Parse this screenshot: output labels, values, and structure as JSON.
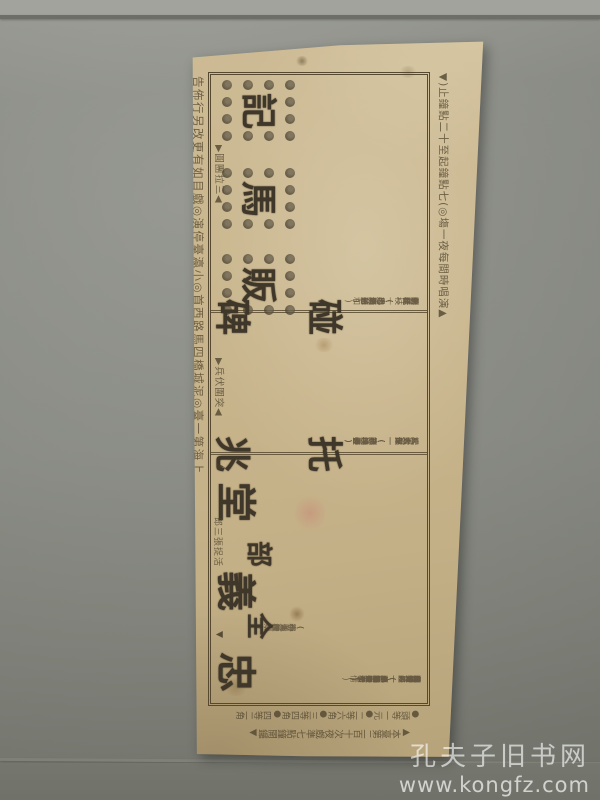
{
  "watermark": {
    "line1": "孔夫子旧书网",
    "line2": "www.kongfz.com"
  },
  "playbill": {
    "header_line": "▲演唱時間每夜一塲◎(七點鐘起至十二點鐘止)▼",
    "footer_line": "上海第一臺◎泥城橋四馬路西首◎小瀛臺停演◎戲目如有更改另行佈告",
    "price_column": "●頭等一元●二等六角●三等四角●四等二角",
    "notice_column": "▲本臺第二百十次夜戲準七點鐘開鑼▼",
    "sections": {
      "fanmaji": {
        "title_chars": [
          "販",
          "馬",
          "記"
        ],
        "subtitle": "◀三拉團圓▶",
        "cast": [
          "李奇—(周信芳)",
          "趙寵—(毛韻珂)",
          "李桂枝—(馮子和)",
          "春花—(小翠花)",
          "田旺—(必全四)",
          "胡氏—(十三旦)",
          "劉氏—(帶玉芳)"
        ]
      },
      "tuozhaopengbei": {
        "title_col_right": [
          "托",
          "兆"
        ],
        "title_col_left": [
          "碰",
          "碑"
        ],
        "subtitle": "◀突圍伏兵▶",
        "cast": [
          "楊繼業—(譚叫天)",
          "楊六郎—(小達子)",
          "楊七郎—(李桂春)",
          "八賢王—(王鴻壽)",
          "大太保—(趙小樓)",
          "二太保—(筱桂芬)"
        ]
      },
      "zhongyitang": {
        "title_main": [
          "忠",
          "義",
          "堂"
        ],
        "title_prefix": [
          "全",
          "部"
        ],
        "subtitle": "活捉張三郎",
        "marker_top": "▲",
        "marker_bottom": "▼",
        "cast": [
          "晁蓋—(王鴻壽)",
          "宋江—(麒麟童)",
          "吳用—(趙如泉)",
          "盧俊義—(小孟七)",
          "公孫勝—(馮志奎)",
          "花榮—(小楊月樓)",
          "燕青—(蓋叫天)",
          "武松—(張德祿)",
          "林沖—(小長生)",
          "閻惜姣—(馮子和)",
          "張文遠—(歐陽予倩)",
          "石秀—(小達子)"
        ],
        "cast_extra": [
          "(一盞燈)",
          "(小九齡)",
          "(賽活猴)",
          "(小王桂卿)",
          "(粉菊花)"
        ]
      }
    }
  }
}
